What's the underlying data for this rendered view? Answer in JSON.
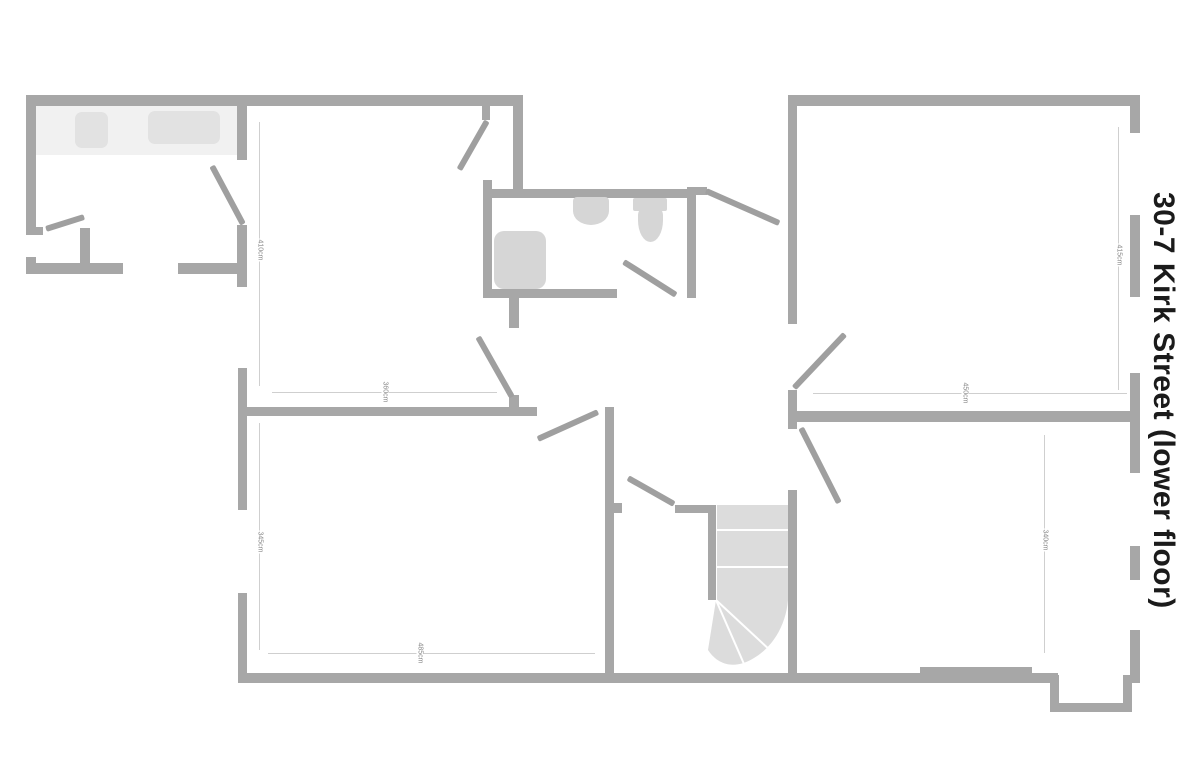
{
  "title": {
    "text": "30-7 Kirk Street (lower floor)"
  },
  "colors": {
    "wall": "#a7a7a7",
    "fixture": "#d6d6d6",
    "stairs": "#dcdcdc",
    "kitchen_counter": "#f1f1f1",
    "appliance": "#e2e2e2",
    "dimension_line": "#cfcfcf",
    "dimension_text": "#8a8a8a",
    "title_text": "#1b1b1b",
    "background": "#ffffff"
  },
  "dimensions": {
    "top_middle_height": "410cm",
    "top_middle_width": "360cm",
    "top_right_height": "415cm",
    "top_right_width": "450cm",
    "bottom_left_height": "345cm",
    "bottom_left_width": "485cm",
    "bottom_right_height": "340cm"
  },
  "fixtures": [
    "kitchen-counter",
    "kitchen-appliance-left",
    "kitchen-appliance-right",
    "shower",
    "sink",
    "toilet",
    "staircase-with-winders",
    "window-bay-notch"
  ]
}
